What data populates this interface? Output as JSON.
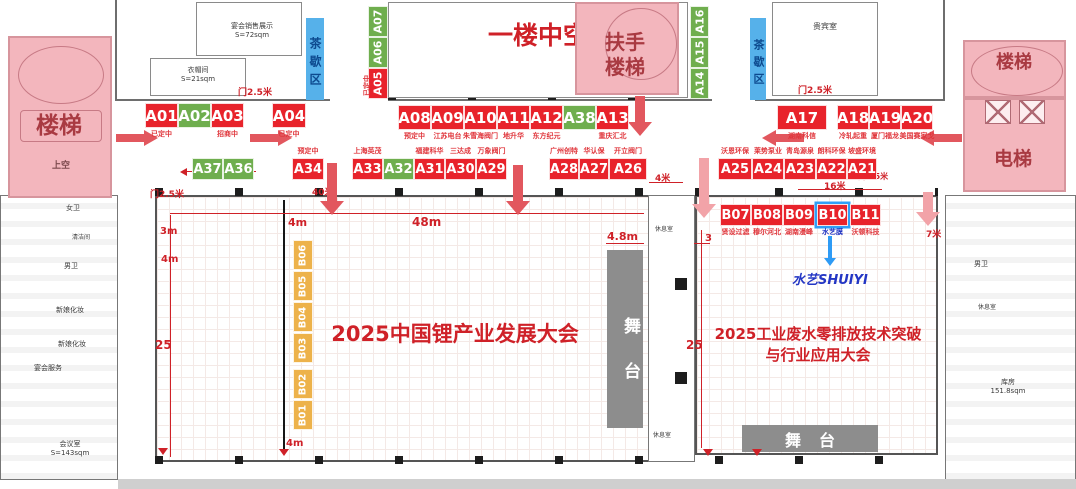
{
  "colors": {
    "booth_red": "#e8232b",
    "booth_green": "#6fae4e",
    "booth_orange": "#edb24a",
    "pink": "#f3b6bd",
    "blue_bar": "#56b1ea",
    "accent_red": "#cf2128",
    "logo_blue": "#2336c4",
    "stage_gray": "#8d8d8d",
    "highlight_blue": "#2f9ff7"
  },
  "titles": {
    "hall_left": "2025中国锂产业发展大会",
    "hall_right_1": "2025工业废水零排放技术突破",
    "hall_right_2": "与行业应用大会",
    "atrium": "一楼中空"
  },
  "zones": {
    "stairs_left": "楼梯",
    "upper": "上空",
    "spiral": "扶手楼梯",
    "stairs_right": "楼梯",
    "elevator": "电梯",
    "tea_left": "茶歇区",
    "tea_right": "茶歇区",
    "stage_left": "舞台",
    "stage_right": "舞台"
  },
  "rooms": {
    "banquet_display": "宴会销售展示",
    "banquet_display_area": "S=72sqm",
    "cloakroom": "衣帽间",
    "cloakroom_area": "S=21sqm",
    "vip": "贵宾室",
    "womens": "女卫",
    "cleaning": "清洁间",
    "mens": "男卫",
    "bridal_a": "新娘化妆",
    "bridal_b": "新娘化妆",
    "banquet_service": "宴会服务",
    "meeting": "会议室",
    "meeting_area": "S=143sqm",
    "mens_right": "男卫",
    "lounge_right": "休息室",
    "storage": "库房",
    "storage_area": "151.8sqm",
    "lounge_mid_top": "休息室",
    "lounge_mid_bottom": "休息室"
  },
  "logo": {
    "text": "水艺SHUIYI"
  },
  "dims": {
    "width48": "48m",
    "aisle4": "4m",
    "bottom4": "4m",
    "left3": "3m",
    "left4": "4m",
    "left25": "25",
    "stage_w": "4.8m",
    "right3": "3",
    "right25": "25",
    "gap4": "4米",
    "len16": "16米",
    "len40": "40米",
    "d7": "7米",
    "door_a": "门2.5米",
    "door_b": "门2.5米",
    "door_c": "门2.5米",
    "door_d": "门2.5米"
  },
  "floor": {
    "booths": [
      {
        "id": "A01",
        "x": 145,
        "y": 103,
        "w": 33,
        "h": 25,
        "c": "red",
        "note": "已定中",
        "np": "b"
      },
      {
        "id": "A02",
        "x": 178,
        "y": 103,
        "w": 33,
        "h": 25,
        "c": "green"
      },
      {
        "id": "A03",
        "x": 211,
        "y": 103,
        "w": 33,
        "h": 25,
        "c": "red",
        "note": "招商中",
        "np": "b"
      },
      {
        "id": "A04",
        "x": 272,
        "y": 103,
        "w": 34,
        "h": 25,
        "c": "red",
        "note": "已定中",
        "np": "b"
      },
      {
        "id": "A07",
        "x": 368,
        "y": 6,
        "w": 20,
        "h": 31,
        "c": "green",
        "vert": true
      },
      {
        "id": "A06",
        "x": 368,
        "y": 37,
        "w": 20,
        "h": 31,
        "c": "green",
        "vert": true
      },
      {
        "id": "A05",
        "x": 368,
        "y": 68,
        "w": 20,
        "h": 31,
        "c": "red",
        "vert": true,
        "note": "已定中",
        "np": "l"
      },
      {
        "id": "A16",
        "x": 690,
        "y": 6,
        "w": 19,
        "h": 31,
        "c": "green",
        "vert": true
      },
      {
        "id": "A15",
        "x": 690,
        "y": 37,
        "w": 19,
        "h": 31,
        "c": "green",
        "vert": true
      },
      {
        "id": "A14",
        "x": 690,
        "y": 68,
        "w": 19,
        "h": 31,
        "c": "green",
        "vert": true
      },
      {
        "id": "A08",
        "x": 398,
        "y": 105,
        "w": 33,
        "h": 25,
        "c": "red",
        "note": "预定中",
        "np": "b"
      },
      {
        "id": "A09",
        "x": 431,
        "y": 105,
        "w": 33,
        "h": 25,
        "c": "red",
        "note": "江苏电台",
        "np": "b"
      },
      {
        "id": "A10",
        "x": 464,
        "y": 105,
        "w": 33,
        "h": 25,
        "c": "red",
        "note": "朱雪海阀门",
        "np": "b"
      },
      {
        "id": "A11",
        "x": 497,
        "y": 105,
        "w": 33,
        "h": 25,
        "c": "red",
        "note": "地升华",
        "np": "b"
      },
      {
        "id": "A12",
        "x": 530,
        "y": 105,
        "w": 33,
        "h": 25,
        "c": "red",
        "note": "东方纪元",
        "np": "b"
      },
      {
        "id": "A38",
        "x": 563,
        "y": 105,
        "w": 33,
        "h": 25,
        "c": "green"
      },
      {
        "id": "A13",
        "x": 596,
        "y": 105,
        "w": 33,
        "h": 25,
        "c": "red",
        "note": "重庆汇北",
        "np": "b"
      },
      {
        "id": "A17",
        "x": 777,
        "y": 105,
        "w": 50,
        "h": 25,
        "c": "red",
        "note": "湖南科信",
        "np": "b"
      },
      {
        "id": "A18",
        "x": 837,
        "y": 105,
        "w": 32,
        "h": 25,
        "c": "red",
        "note": "冷轧起重",
        "np": "b"
      },
      {
        "id": "A19",
        "x": 869,
        "y": 105,
        "w": 32,
        "h": 25,
        "c": "red",
        "note": "厦门福龙",
        "np": "b"
      },
      {
        "id": "A20",
        "x": 901,
        "y": 105,
        "w": 32,
        "h": 25,
        "c": "red",
        "note": "美国赛家戈",
        "np": "b"
      },
      {
        "id": "A37",
        "x": 192,
        "y": 158,
        "w": 31,
        "h": 22,
        "c": "green"
      },
      {
        "id": "A36",
        "x": 223,
        "y": 158,
        "w": 31,
        "h": 22,
        "c": "green"
      },
      {
        "id": "A34",
        "x": 292,
        "y": 158,
        "w": 32,
        "h": 22,
        "c": "red",
        "note": "预定中",
        "np": "a"
      },
      {
        "id": "A33",
        "x": 352,
        "y": 158,
        "w": 31,
        "h": 22,
        "c": "red",
        "note": "上海英茂",
        "np": "a"
      },
      {
        "id": "A32",
        "x": 383,
        "y": 158,
        "w": 31,
        "h": 22,
        "c": "green"
      },
      {
        "id": "A31",
        "x": 414,
        "y": 158,
        "w": 31,
        "h": 22,
        "c": "red",
        "note": "福建科华",
        "np": "a"
      },
      {
        "id": "A30",
        "x": 445,
        "y": 158,
        "w": 31,
        "h": 22,
        "c": "red",
        "note": "三达成",
        "np": "a"
      },
      {
        "id": "A29",
        "x": 476,
        "y": 158,
        "w": 31,
        "h": 22,
        "c": "red",
        "note": "万象阀门",
        "np": "a"
      },
      {
        "id": "A28",
        "x": 549,
        "y": 158,
        "w": 30,
        "h": 22,
        "c": "red",
        "note": "广州创特",
        "np": "a"
      },
      {
        "id": "A27",
        "x": 579,
        "y": 158,
        "w": 30,
        "h": 22,
        "c": "red",
        "note": "华认保",
        "np": "a"
      },
      {
        "id": "A26",
        "x": 609,
        "y": 158,
        "w": 38,
        "h": 22,
        "c": "red",
        "note": "开立阀门",
        "np": "a"
      },
      {
        "id": "A25",
        "x": 718,
        "y": 158,
        "w": 34,
        "h": 22,
        "c": "red",
        "note": "沃恩环保",
        "np": "a"
      },
      {
        "id": "A24",
        "x": 752,
        "y": 158,
        "w": 32,
        "h": 22,
        "c": "red",
        "note": "莱势泵业",
        "np": "a"
      },
      {
        "id": "A23",
        "x": 784,
        "y": 158,
        "w": 32,
        "h": 22,
        "c": "red",
        "note": "青岛源泉",
        "np": "a"
      },
      {
        "id": "A22",
        "x": 816,
        "y": 158,
        "w": 31,
        "h": 22,
        "c": "red",
        "note": "朗科环保",
        "np": "a"
      },
      {
        "id": "A21",
        "x": 847,
        "y": 158,
        "w": 30,
        "h": 22,
        "c": "red",
        "note": "坡盛环境",
        "np": "a"
      },
      {
        "id": "B07",
        "x": 720,
        "y": 204,
        "w": 31,
        "h": 22,
        "c": "red",
        "note": "贤设过滤",
        "np": "b"
      },
      {
        "id": "B08",
        "x": 751,
        "y": 204,
        "w": 32,
        "h": 22,
        "c": "red",
        "note": "穆尔河北",
        "np": "b"
      },
      {
        "id": "B09",
        "x": 783,
        "y": 204,
        "w": 32,
        "h": 22,
        "c": "red",
        "note": "湖南漫峰",
        "np": "b"
      },
      {
        "id": "B10",
        "x": 817,
        "y": 204,
        "w": 31,
        "h": 22,
        "c": "red",
        "note": "水艺膜",
        "np": "b",
        "hl": true,
        "nc": "blue"
      },
      {
        "id": "B11",
        "x": 850,
        "y": 204,
        "w": 31,
        "h": 22,
        "c": "red",
        "note": "沃顿科技",
        "np": "b"
      },
      {
        "id": "B06",
        "x": 293,
        "y": 240,
        "w": 20,
        "h": 30,
        "c": "orange",
        "vert": true
      },
      {
        "id": "B05",
        "x": 293,
        "y": 271,
        "w": 20,
        "h": 30,
        "c": "orange",
        "vert": true
      },
      {
        "id": "B04",
        "x": 293,
        "y": 302,
        "w": 20,
        "h": 30,
        "c": "orange",
        "vert": true
      },
      {
        "id": "B03",
        "x": 293,
        "y": 333,
        "w": 20,
        "h": 30,
        "c": "orange",
        "vert": true
      },
      {
        "id": "B02",
        "x": 293,
        "y": 369,
        "w": 20,
        "h": 30,
        "c": "orange",
        "vert": true
      },
      {
        "id": "B01",
        "x": 293,
        "y": 400,
        "w": 20,
        "h": 30,
        "c": "orange",
        "vert": true
      }
    ]
  }
}
